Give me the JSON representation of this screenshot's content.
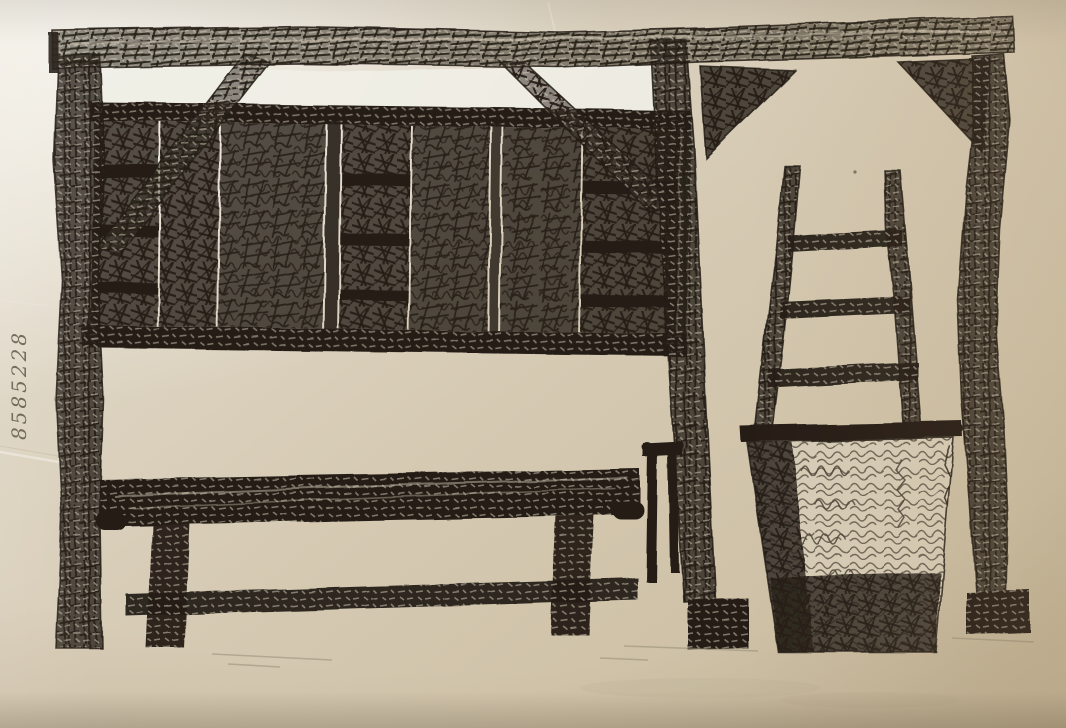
{
  "artwork": {
    "kind": "pen-and-ink sketch on paper (photographed)",
    "inscription": {
      "text": "8585228",
      "orientation": "rotated 90° on left margin"
    },
    "depicted": [
      "timber frame with long top beam",
      "hay-filled wall panels with shelf rails",
      "diagonal knee braces",
      "open gateway with corner gussets and gnarled posts",
      "wooden ladder",
      "wicker basket with hay",
      "long wooden bench with stretcher",
      "small two-pronged wooden tool"
    ]
  },
  "palette": {
    "paper-light": "#eee9df",
    "paper": "#d9cfbb",
    "paper-warm": "#cbbda1",
    "band": "#f1efe7",
    "ink": "#251f18",
    "ink-soft": "#3b332a",
    "pencil": "#968c77"
  }
}
